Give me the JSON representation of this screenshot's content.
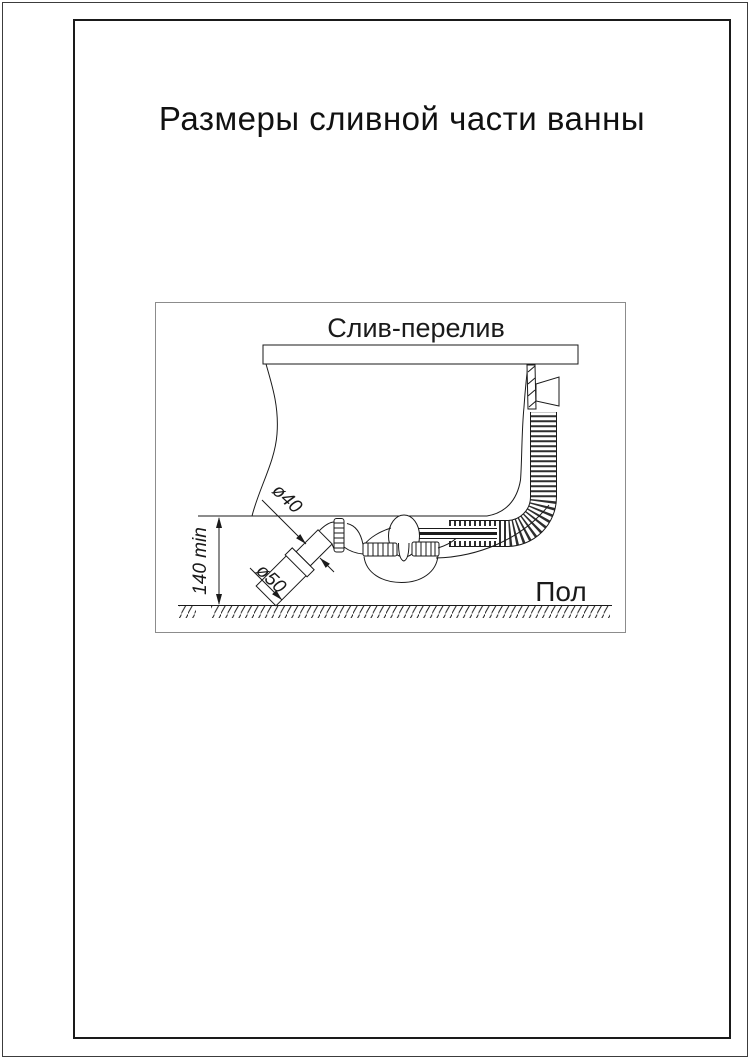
{
  "page": {
    "title": "Размеры сливной части ванны"
  },
  "figure": {
    "title": "Слив-перелив",
    "floor_label": "Пол",
    "dimensions": {
      "height_min": "140 min",
      "drain_diameter": "ø40",
      "outlet_diameter": "ø50"
    },
    "colors": {
      "line": "#1a1a1a",
      "page_frame": "#1a1a1a",
      "figure_border": "#8c8c8c",
      "corrugation": "#2e2e2e",
      "background": "#ffffff"
    }
  }
}
